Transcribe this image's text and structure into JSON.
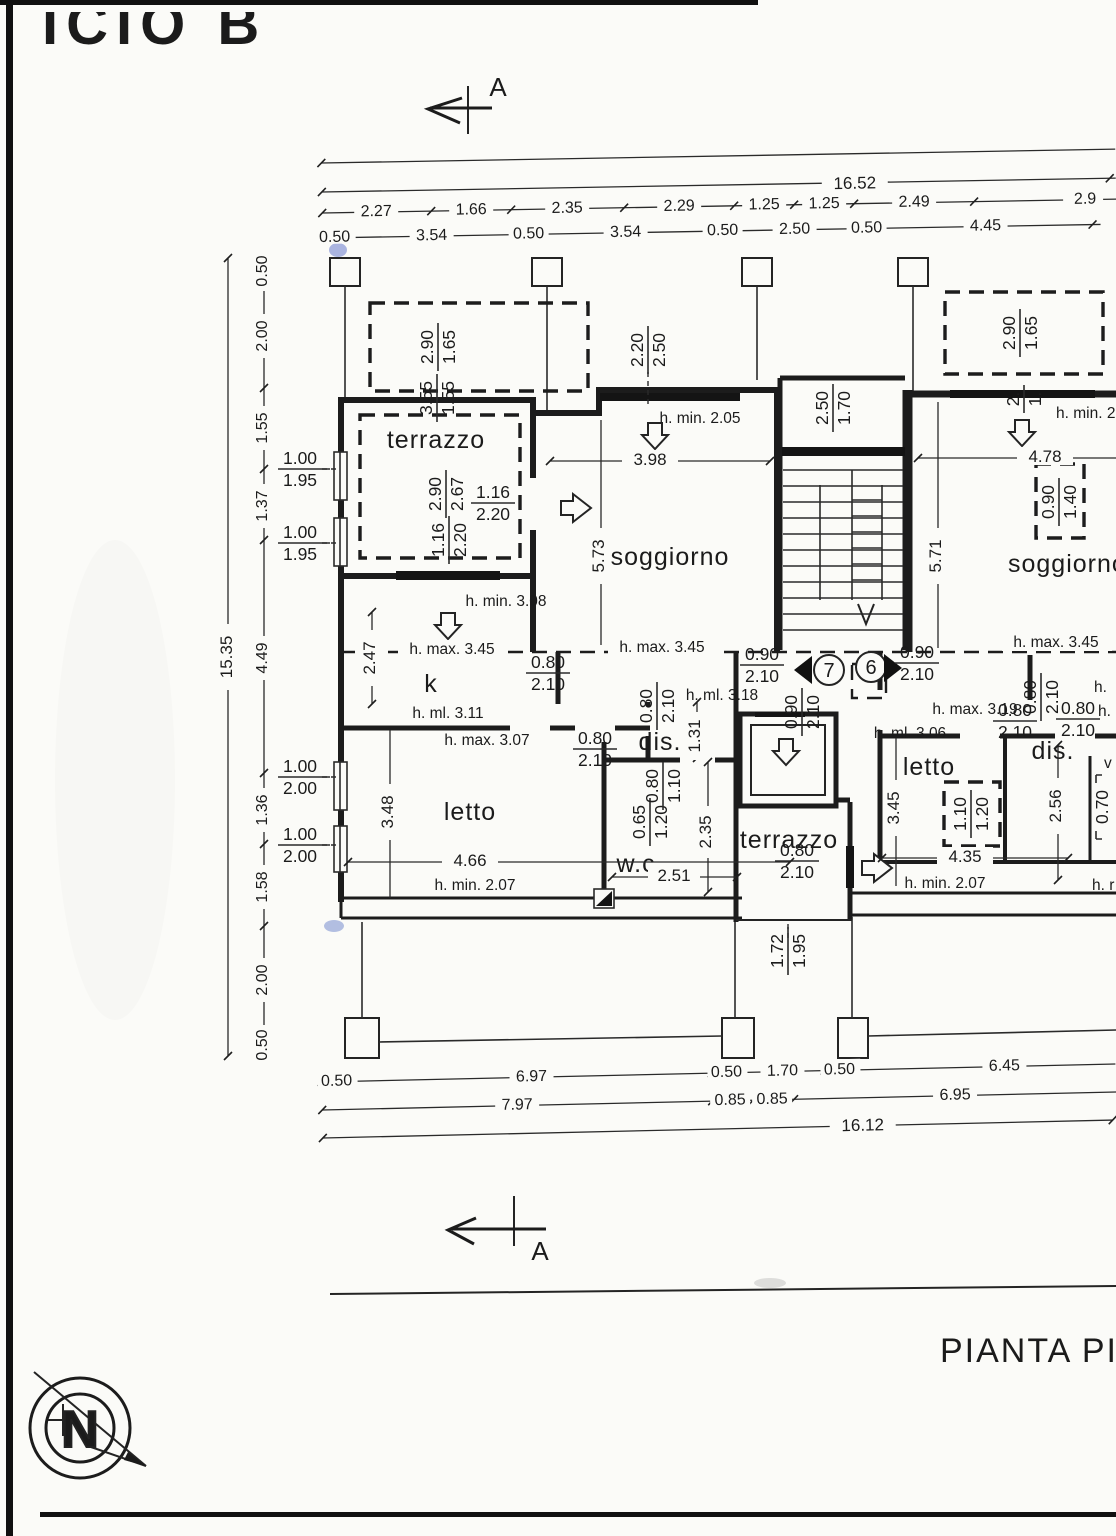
{
  "page": {
    "sheet_title": "ICIO B",
    "plan_title": "PIANTA PIA",
    "section_marker_top": "A",
    "section_marker_bottom": "A",
    "north_letter": "N"
  },
  "rooms": {
    "terrazzo_nw": "terrazzo",
    "soggiorno": "soggiorno",
    "soggiorno_right": "soggiorno",
    "kitchen": "k",
    "dis_left": "dis.",
    "wc": "w.c.",
    "letto_left": "letto",
    "ascensore": "ascensore",
    "terrazzo_south": "terrazzo",
    "letto_right": "letto",
    "dis_right": "dis."
  },
  "unit_doors": {
    "left": "7",
    "right": "6"
  },
  "chains": {
    "top": {
      "total": "16.52",
      "segments": [
        "2.27",
        "1.66",
        "2.35",
        "2.29",
        "1.25",
        "1.25",
        "2.49",
        "2.9"
      ],
      "walls": [
        "0.50",
        "3.54",
        "0.50",
        "3.54",
        "0.50",
        "2.50",
        "0.50",
        "4.45"
      ]
    },
    "left": {
      "total": "15.35",
      "items": [
        "0.50",
        "2.00",
        "1.55",
        "1.37",
        "4.49",
        "1.36",
        "1.58",
        "2.00",
        "0.50"
      ]
    },
    "bottom": {
      "walls": [
        "0.50",
        "6.97",
        "0.50",
        "1.70",
        "0.50",
        "6.45"
      ],
      "inner": [
        "7.97",
        "0.85",
        "0.85",
        "6.95"
      ],
      "total": "16.12"
    }
  },
  "dims": {
    "soggiorno_w": "3.98",
    "soggiorno_h": "5.73",
    "right_wing_h": "5.71",
    "soggiorno_right_w": "4.78",
    "kitchen_h": "2.47",
    "letto_w": "4.66",
    "letto_h": "3.48",
    "wc_w": "2.51",
    "wc_h": "2.35",
    "dis_h": "1.31",
    "letto_right_w": "4.35",
    "letto_right_h": "3.45",
    "dis_right_h": "2.56",
    "dis_right_w": "0.70"
  },
  "openings": {
    "balcony_nw": {
      "n": "2.90",
      "d": "1.65"
    },
    "balcony_ne": {
      "n": "2.90",
      "d": "1.65"
    },
    "terrazzo_top": {
      "n": "3.55",
      "d": "1.55"
    },
    "terrazzo_main": {
      "n": "2.90",
      "d": "2.67"
    },
    "terrazzo_door_e": {
      "n": "1.16",
      "d": "2.20"
    },
    "terrazzo_door_s": {
      "n": "1.16",
      "d": "2.20"
    },
    "soggiorno_window": {
      "n": "2.20",
      "d": "2.50"
    },
    "stair_window": {
      "n": "2.50",
      "d": "1.70"
    },
    "ne_fragment": {
      "n": "2.",
      "d": "1."
    },
    "soggiorno_right_window": {
      "n": "0.90",
      "d": "1.40"
    },
    "kitchen_door": {
      "n": "0.80",
      "d": "2.10"
    },
    "dis_left_door": {
      "n": "0.80",
      "d": "2.10"
    },
    "letto_left_door": {
      "n": "0.80",
      "d": "2.10"
    },
    "hall_door_left": {
      "n": "0.90",
      "d": "2.10"
    },
    "hall_door_right": {
      "n": "0.90",
      "d": "2.10"
    },
    "elevator_door": {
      "n": "0.90",
      "d": "2.10"
    },
    "wc_window": {
      "n": "0.65",
      "d": "1.20"
    },
    "wc_door": {
      "n": "0.80",
      "d": "1.10"
    },
    "window_l1": {
      "n": "1.00",
      "d": "1.95"
    },
    "window_l2": {
      "n": "1.00",
      "d": "1.95"
    },
    "window_l3": {
      "n": "1.00",
      "d": "2.00"
    },
    "window_l4": {
      "n": "1.00",
      "d": "2.00"
    },
    "terrazzo_s_door": {
      "n": "0.80",
      "d": "2.10"
    },
    "terrazzo_s_window": {
      "n": "1.72",
      "d": "1.95"
    },
    "letto_right_window": {
      "n": "1.10",
      "d": "1.20"
    },
    "dis_right_door_top": {
      "n": "0.80",
      "d": "2.10"
    },
    "dis_right_door_a": {
      "n": "0.80",
      "d": "2.10"
    },
    "dis_right_door_b": {
      "n": "0.80",
      "d": "2.10"
    }
  },
  "heights": {
    "soggiorno_min": "h. min. 2.05",
    "right_min": "h. min. 2",
    "max_345_a": "h. max. 3.45",
    "max_345_b": "h. max. 3.45",
    "max_345_c": "h. max. 3.45",
    "min_308": "h. min. 3.08",
    "ml_311": "h. ml. 3.11",
    "max_307": "h. max. 3.07",
    "ml_318": "h. ml. 3.18",
    "max_319": "h. max. 3.19",
    "ml_306": "h. ml. 3.06",
    "min_207_a": "h. min. 2.07",
    "min_207_b": "h. min. 2.07",
    "frag_a": "h.",
    "frag_b": "h.",
    "frag_c": "h. r",
    "frag_v": "v"
  }
}
